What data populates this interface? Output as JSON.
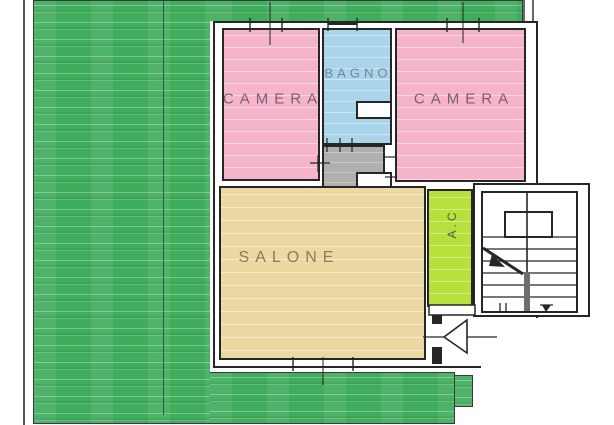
{
  "plan": {
    "type": "apartment-floor-plan",
    "rooms": [
      {
        "id": "camera-left",
        "label": "CAMERA"
      },
      {
        "id": "bagno",
        "label": "BAGNO"
      },
      {
        "id": "camera-right",
        "label": "CAMERA"
      },
      {
        "id": "salone",
        "label": "SALONE"
      },
      {
        "id": "ac",
        "label": "A.C"
      }
    ]
  },
  "palette": {
    "garden_green": "#3fad5c",
    "room_pink": "#f6b4cb",
    "room_blue": "#a9d4e9",
    "room_beige": "#ebd8a2",
    "room_lime": "#b7e03c",
    "hall_gray": "#b1b0ae",
    "wall_black": "#262626"
  }
}
